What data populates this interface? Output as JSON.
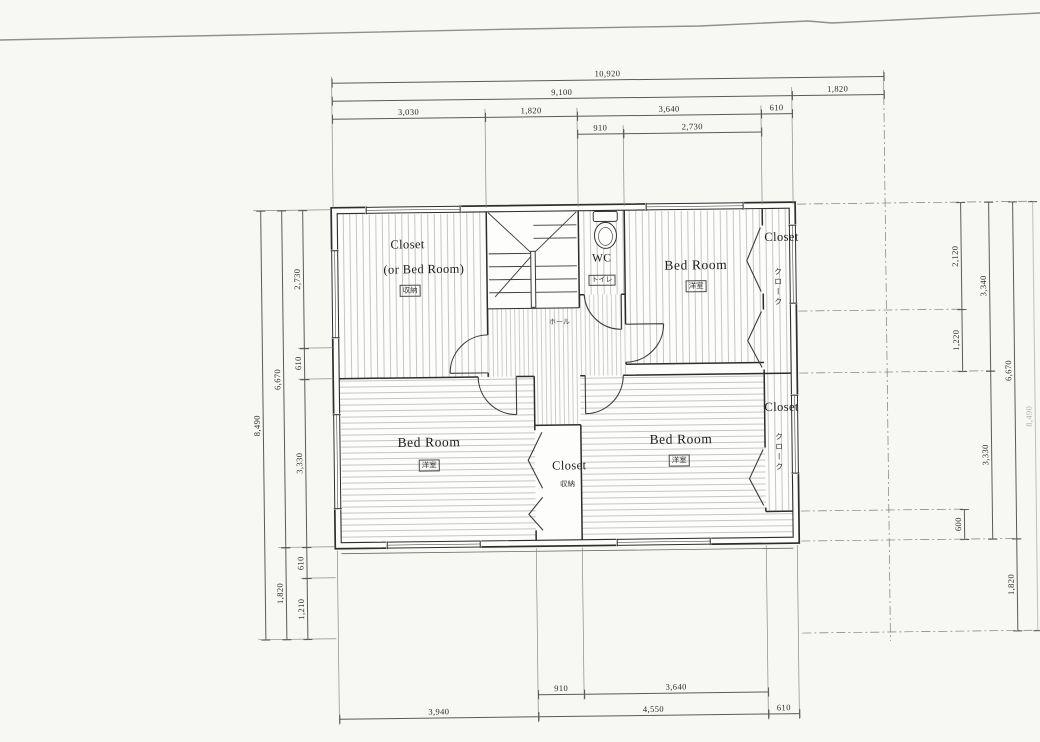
{
  "drawing": {
    "type": "architectural floor plan (scanned)",
    "units": "mm",
    "rooms": [
      {
        "id": "closet-nw",
        "en": "Closet",
        "en2": "(or Bed Room)",
        "jp": "収納"
      },
      {
        "id": "wc",
        "en": "WC",
        "jp": "トイレ"
      },
      {
        "id": "bedroom-ne",
        "en": "Bed Room",
        "jp": "洋室"
      },
      {
        "id": "closet-ne",
        "en": "Closet",
        "jp": "クローク"
      },
      {
        "id": "closet-e",
        "en": "Closet",
        "jp": "クローク"
      },
      {
        "id": "bedroom-sw",
        "en": "Bed Room",
        "jp": "洋室"
      },
      {
        "id": "closet-s",
        "en": "Closet",
        "jp": "収納"
      },
      {
        "id": "bedroom-se",
        "en": "Bed Room",
        "jp": "洋室"
      },
      {
        "id": "hall",
        "jp": "ホール"
      }
    ],
    "dimensions": {
      "top": [
        {
          "row": 0,
          "start": 0,
          "len": 10920,
          "label": "10,920"
        },
        {
          "row": 1,
          "start": 0,
          "len": 9100,
          "label": "9,100"
        },
        {
          "row": 1,
          "start": 9100,
          "len": 1820,
          "label": "1,820"
        },
        {
          "row": 2,
          "start": 0,
          "len": 3030,
          "label": "3,030"
        },
        {
          "row": 2,
          "start": 3030,
          "len": 1820,
          "label": "1,820"
        },
        {
          "row": 2,
          "start": 4850,
          "len": 3640,
          "label": "3,640"
        },
        {
          "row": 2,
          "start": 8490,
          "len": 610,
          "label": "610"
        },
        {
          "row": 3,
          "start": 4850,
          "len": 910,
          "label": "910"
        },
        {
          "row": 3,
          "start": 5760,
          "len": 2730,
          "label": "2,730"
        }
      ],
      "bottom": [
        {
          "row": 0,
          "start": 3940,
          "len": 910,
          "label": "910"
        },
        {
          "row": 0,
          "start": 4850,
          "len": 3640,
          "label": "3,640"
        },
        {
          "row": 1,
          "start": 0,
          "len": 3940,
          "label": "3,940"
        },
        {
          "row": 1,
          "start": 3940,
          "len": 4550,
          "label": "4,550"
        },
        {
          "row": 1,
          "start": 8490,
          "len": 610,
          "label": "610"
        }
      ],
      "left": [
        {
          "col": 0,
          "start": 0,
          "len": 2730,
          "label": "2,730"
        },
        {
          "col": 0,
          "start": 2730,
          "len": 610,
          "label": "610"
        },
        {
          "col": 0,
          "start": 3340,
          "len": 3330,
          "label": "3,330"
        },
        {
          "col": 0,
          "start": 6670,
          "len": 610,
          "label": "610"
        },
        {
          "col": 0,
          "start": 7280,
          "len": 1210,
          "label": "1,210"
        },
        {
          "col": 1,
          "start": 0,
          "len": 6670,
          "label": "6,670"
        },
        {
          "col": 1,
          "start": 6670,
          "len": 1820,
          "label": "1,820"
        },
        {
          "col": 2,
          "start": 0,
          "len": 8490,
          "label": "8,490"
        }
      ],
      "right": [
        {
          "col": 0,
          "start": 0,
          "len": 2120,
          "label": "2,120"
        },
        {
          "col": 0,
          "start": 2120,
          "len": 1220,
          "label": "1,220"
        },
        {
          "col": 0,
          "start": 6070,
          "len": 600,
          "label": "600"
        },
        {
          "col": 1,
          "start": 0,
          "len": 3340,
          "label": "3,340"
        },
        {
          "col": 1,
          "start": 3340,
          "len": 3330,
          "label": "3,330"
        },
        {
          "col": 2,
          "start": 0,
          "len": 6670,
          "label": "6,670"
        },
        {
          "col": 2,
          "start": 6670,
          "len": 1820,
          "label": "1,820"
        },
        {
          "col": 3,
          "start": 0,
          "len": 8490,
          "label": "8,490",
          "faint": true
        }
      ]
    }
  }
}
